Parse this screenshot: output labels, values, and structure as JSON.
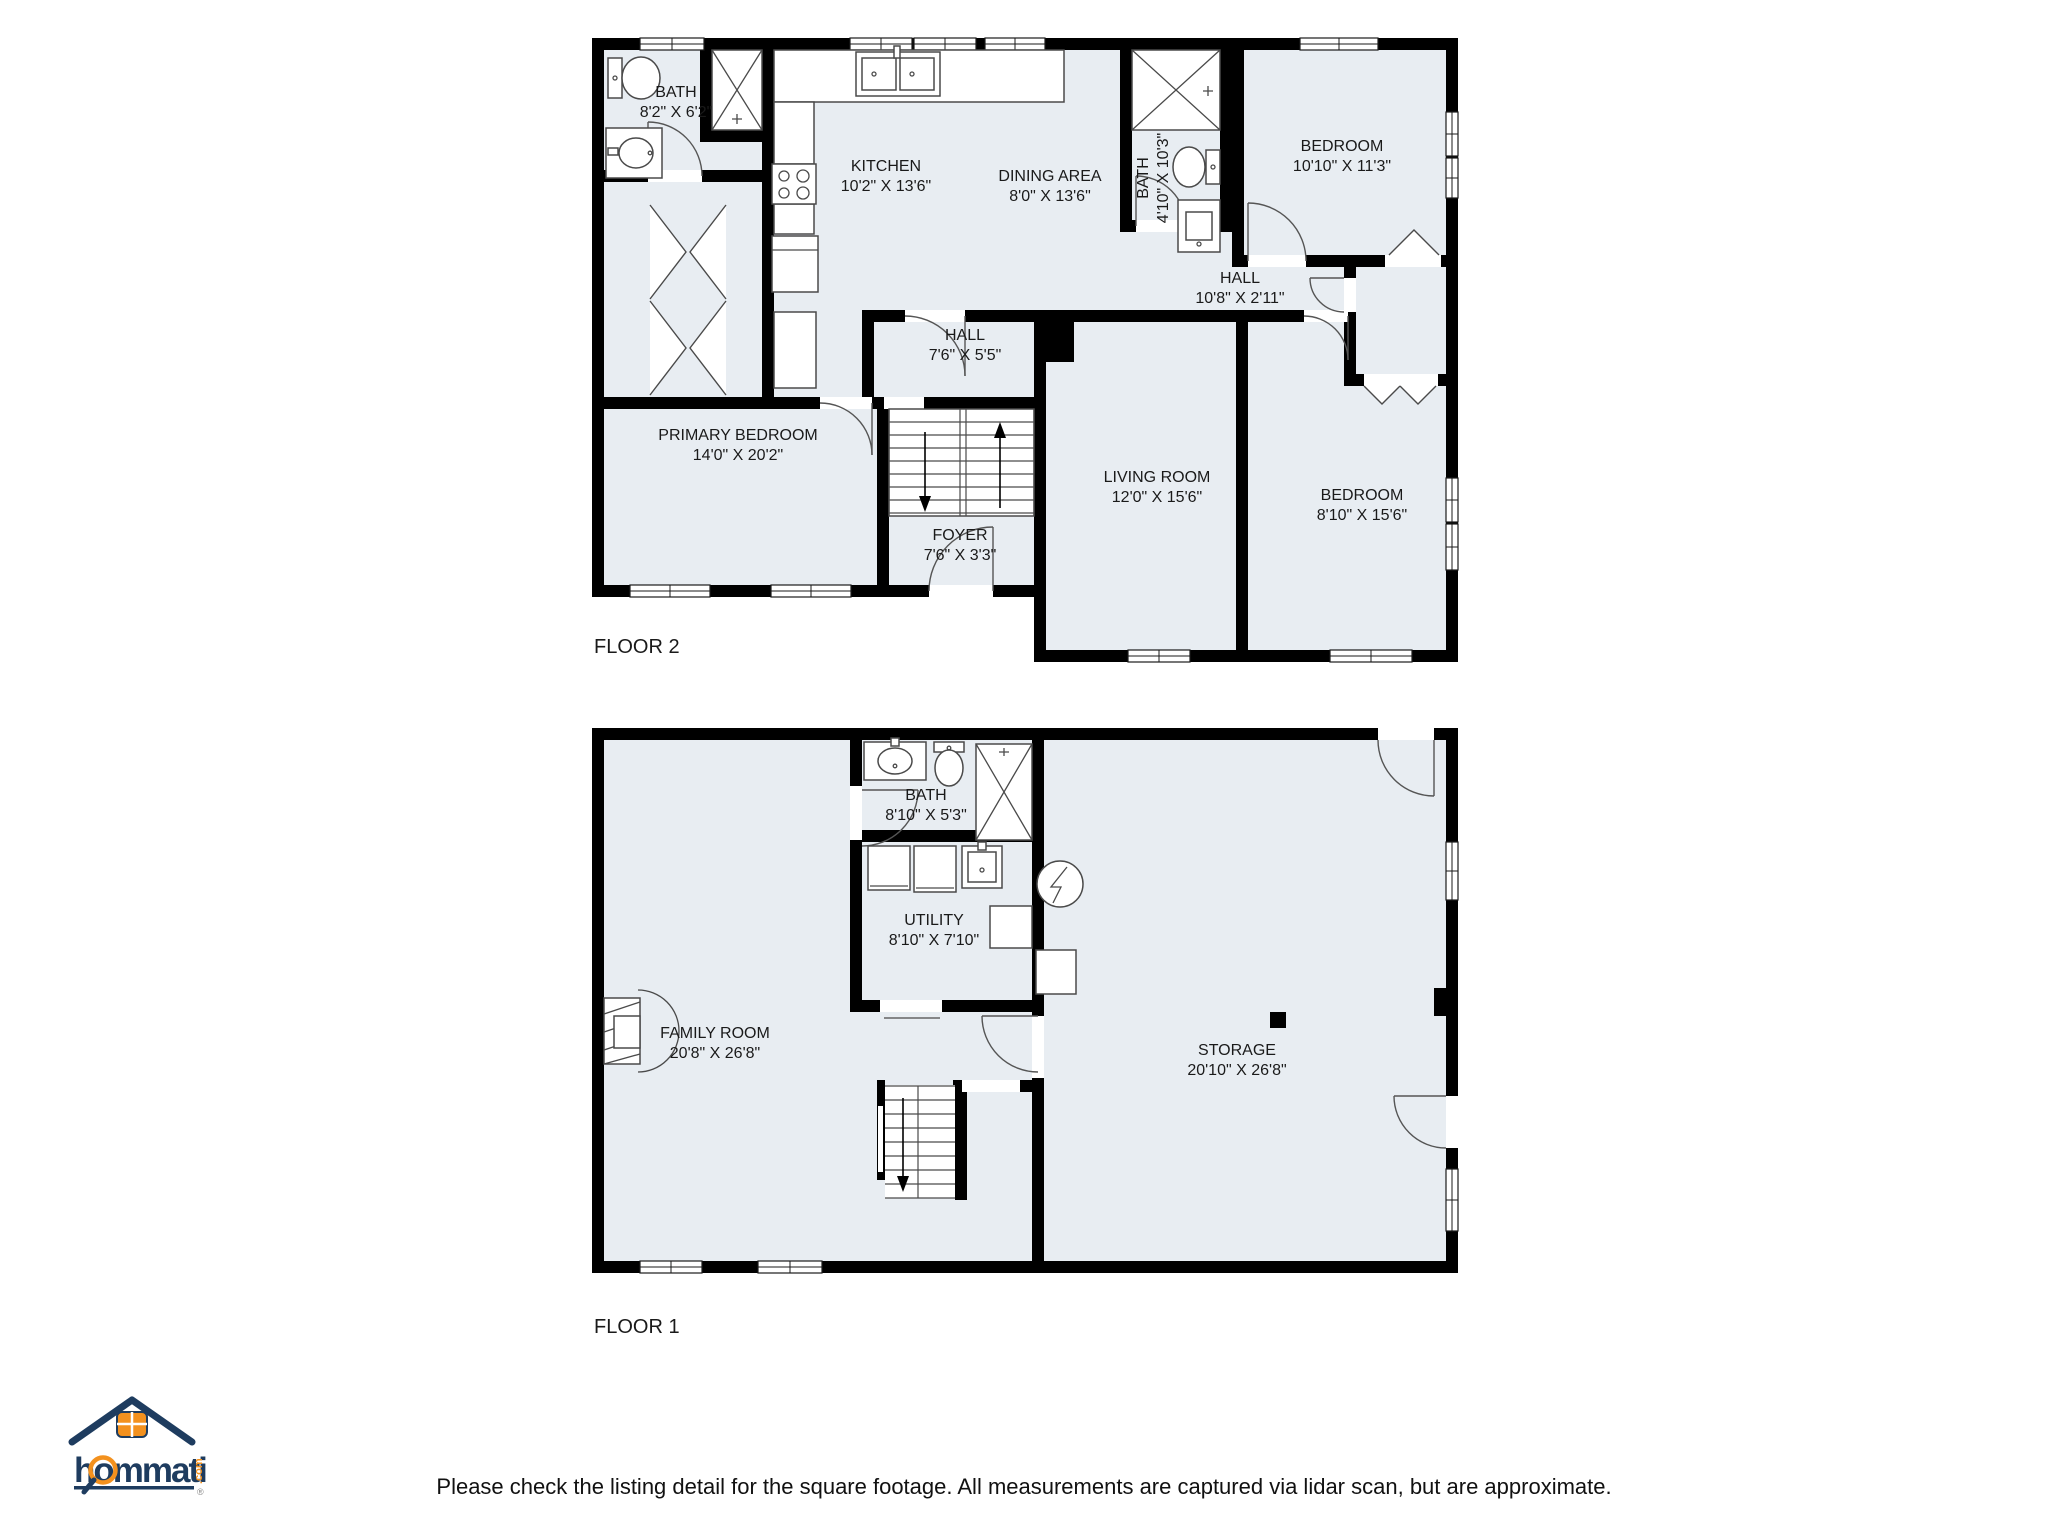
{
  "colors": {
    "room_fill": "#e8edf2",
    "wall": "#000000",
    "fixture_stroke": "#4a4a4a",
    "text": "#1a1a1a",
    "logo_navy": "#1e3c5f",
    "logo_orange": "#f3911e"
  },
  "floors": [
    {
      "label": "FLOOR 2",
      "rooms": [
        {
          "name": "BATH",
          "dims": "8'2\" X 6'2\""
        },
        {
          "name": "KITCHEN",
          "dims": "10'2\" X 13'6\""
        },
        {
          "name": "DINING AREA",
          "dims": "8'0\" X 13'6\""
        },
        {
          "name": "BATH",
          "dims": "4'10\" X 10'3\""
        },
        {
          "name": "BEDROOM",
          "dims": "10'10\" X 11'3\""
        },
        {
          "name": "HALL",
          "dims": "10'8\" X 2'11\""
        },
        {
          "name": "HALL",
          "dims": "7'6\" X 5'5\""
        },
        {
          "name": "PRIMARY BEDROOM",
          "dims": "14'0\" X 20'2\""
        },
        {
          "name": "LIVING ROOM",
          "dims": "12'0\" X 15'6\""
        },
        {
          "name": "BEDROOM",
          "dims": "8'10\" X 15'6\""
        },
        {
          "name": "FOYER",
          "dims": "7'6\" X 3'3\""
        }
      ]
    },
    {
      "label": "FLOOR 1",
      "rooms": [
        {
          "name": "BATH",
          "dims": "8'10\" X 5'3\""
        },
        {
          "name": "UTILITY",
          "dims": "8'10\" X 7'10\""
        },
        {
          "name": "FAMILY ROOM",
          "dims": "20'8\" X 26'8\""
        },
        {
          "name": "STORAGE",
          "dims": "20'10\" X 26'8\""
        }
      ]
    }
  ],
  "logo": {
    "brand": "hommati",
    "tld": ".com",
    "registered": "®"
  },
  "disclaimer": "Please check the listing detail for the square footage. All measurements are captured via lidar scan, but are approximate."
}
